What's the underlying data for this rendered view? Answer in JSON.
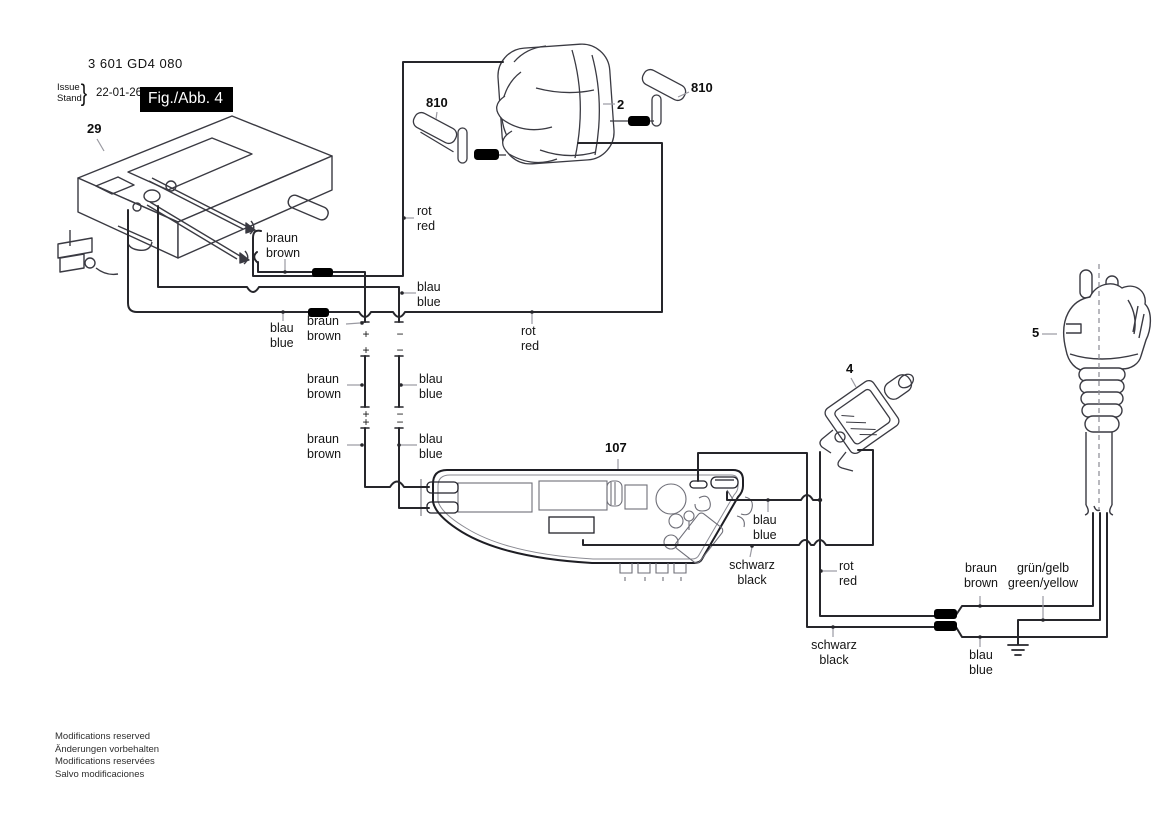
{
  "header": {
    "part_number": "3 601 GD4 080",
    "issue_label": "Issue",
    "stand_label": "Stand",
    "brace": "}",
    "date": "22-01-26",
    "figure_label": "Fig./Abb. 4"
  },
  "part_numbers": {
    "switch": "29",
    "field_coil": "2",
    "brush_left": "810",
    "brush_right": "810",
    "suppressor": "4",
    "plug": "5",
    "module": "107"
  },
  "wire_labels": {
    "l1": {
      "de": "braun",
      "en": "brown"
    },
    "l2": {
      "de": "rot",
      "en": "red"
    },
    "l3": {
      "de": "blau",
      "en": "blue"
    },
    "l4": {
      "de": "blau",
      "en": "blue"
    },
    "l5": {
      "de": "braun",
      "en": "brown"
    },
    "l6": {
      "de": "rot",
      "en": "red"
    },
    "l7": {
      "de": "braun",
      "en": "brown"
    },
    "l8": {
      "de": "blau",
      "en": "blue"
    },
    "l9": {
      "de": "braun",
      "en": "brown"
    },
    "l10": {
      "de": "blau",
      "en": "blue"
    },
    "l11": {
      "de": "blau",
      "en": "blue"
    },
    "l12": {
      "de": "schwarz",
      "en": "black"
    },
    "l13": {
      "de": "rot",
      "en": "red"
    },
    "l14": {
      "de": "schwarz",
      "en": "black"
    },
    "l15": {
      "de": "braun",
      "en": "brown"
    },
    "l16": {
      "de": "grün/gelb",
      "en": "green/yellow"
    },
    "l17": {
      "de": "blau",
      "en": "blue"
    }
  },
  "polarity": {
    "plus": "+",
    "minus": "−"
  },
  "footer": {
    "lines": [
      "Modifications reserved",
      "Änderungen vorbehalten",
      "Modifications reservées",
      "Salvo modificaciones"
    ]
  },
  "colors": {
    "wire": "#26262b",
    "art": "#3a3a42",
    "component": "#6f6f78",
    "leader": "#9a9aa2",
    "blob": "#000000"
  }
}
